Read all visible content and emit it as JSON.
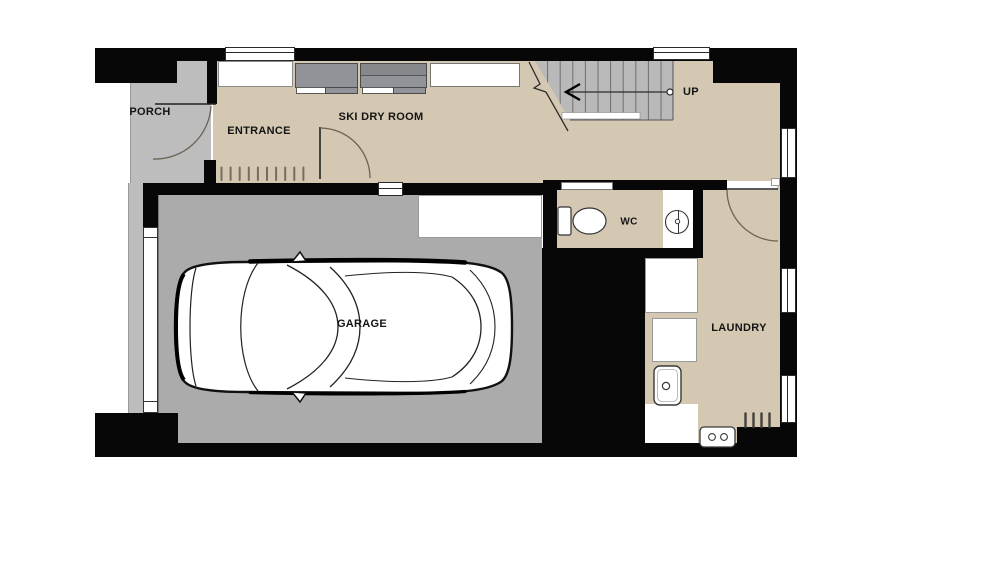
{
  "plan": {
    "rooms": {
      "porch": {
        "label": "PORCH"
      },
      "entrance": {
        "label": "ENTRANCE"
      },
      "ski_dry_room": {
        "label": "SKI DRY ROOM"
      },
      "wc": {
        "label": "WC"
      },
      "garage": {
        "label": "GARAGE"
      },
      "laundry": {
        "label": "LAUNDRY"
      }
    },
    "stairs": {
      "label": "UP",
      "tread_count": 10
    },
    "colors": {
      "wall": "#070707",
      "floor": "#d4c8b2",
      "porch": "#bdbdbd",
      "garage": "#ababab",
      "stair": "#b9b9b9",
      "cabinet": "#929398",
      "cabinet-dark": "#87888c",
      "line": "#2b2b2b",
      "door-arc": "#6e6355",
      "text": "#141414"
    }
  }
}
